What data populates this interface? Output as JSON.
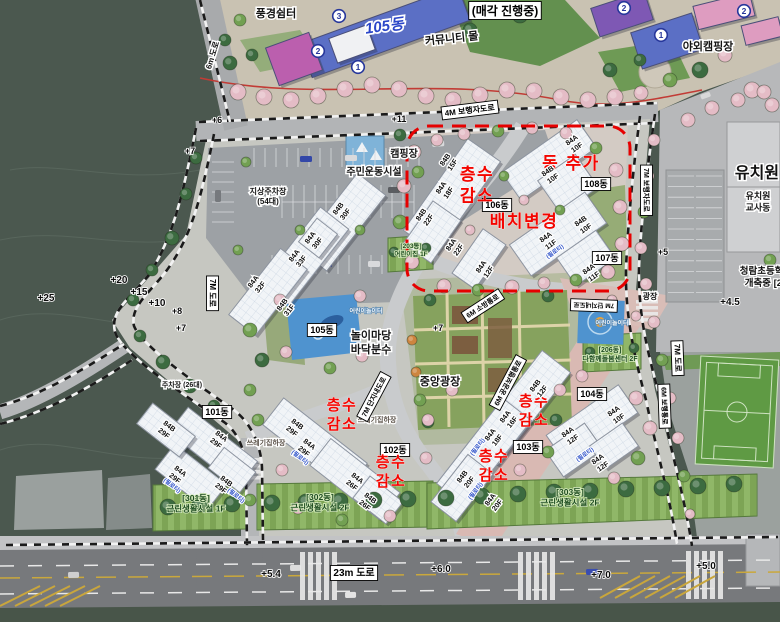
{
  "colors": {
    "annotation_red": "#f30500",
    "change_area_outline": "#e60000",
    "dong_blue": "#2b46c8",
    "building_fill": "#f1f4f7",
    "field_dark": "#4b584f"
  },
  "label_format": [
    "name",
    "text",
    "x",
    "y",
    "rotation",
    "class",
    "font_size"
  ],
  "labels": [
    [
      "bldg-105-main-label",
      "105동",
      385,
      31,
      -8,
      "bluedong",
      15
    ],
    [
      "sale-status-label",
      "(매각 진행중)",
      505,
      15,
      0,
      "box",
      12
    ],
    [
      "punggyeong-shelter-label",
      "풍경쉼터",
      276,
      17,
      0,
      "halo",
      11
    ],
    [
      "community-mall-label",
      "커뮤니티 몰",
      452,
      42,
      -6,
      "halo",
      11
    ],
    [
      "outdoor-camping-label",
      "야외캠핑장",
      708,
      50,
      0,
      "halo",
      11
    ],
    [
      "camping-label",
      "캠핑장",
      404,
      157,
      0,
      "halo",
      10
    ],
    [
      "sports-facility-label",
      "주민운동시설",
      374,
      175,
      0,
      "halo",
      10
    ],
    [
      "ground-parking-label",
      "지상주차장\n(54대)",
      268,
      194,
      0,
      "halo",
      8
    ],
    [
      "parking-26-label",
      "주차장 (26대)",
      182,
      387,
      0,
      "halo",
      7
    ],
    [
      "play-yard-label",
      "놀이마당\n바닥분수",
      371,
      339,
      0,
      "halo",
      11
    ],
    [
      "kids-playground-label-1",
      "어린이놀이터",
      366,
      313,
      0,
      "white",
      6
    ],
    [
      "kids-playground-label-2",
      "어린이놀이터",
      612,
      325,
      0,
      "white",
      6
    ],
    [
      "central-plaza-label",
      "중앙광장",
      440,
      385,
      0,
      "halo",
      11
    ],
    [
      "plaza-label",
      "광장",
      650,
      299,
      0,
      "halo",
      8
    ],
    [
      "waste-station-label-1",
      "쓰레기집하장",
      377,
      422,
      0,
      "halo2",
      7
    ],
    [
      "waste-station-label-2",
      "쓰레기집하장",
      266,
      445,
      0,
      "halo2",
      7
    ],
    [
      "kindergarten-label",
      "유치원",
      757,
      178,
      0,
      "big",
      16
    ],
    [
      "kindergarten-annex-label",
      "유치원\n교사동",
      758,
      199,
      0,
      "halo",
      9
    ],
    [
      "school-label",
      "청람초등학교\n개축중 [25",
      766,
      274,
      0,
      "school",
      9.5
    ],
    [
      "dong-101-label",
      "101동",
      217,
      415,
      0,
      "box",
      9
    ],
    [
      "dong-102-label",
      "102동",
      395,
      453,
      0,
      "box",
      9
    ],
    [
      "dong-103-label",
      "103동",
      528,
      450,
      0,
      "box",
      9
    ],
    [
      "dong-104-label",
      "104동",
      592,
      397,
      0,
      "box",
      9
    ],
    [
      "dong-105-label",
      "105동",
      322,
      333,
      0,
      "box",
      9
    ],
    [
      "dong-106-label",
      "106동",
      497,
      208,
      0,
      "box",
      9
    ],
    [
      "dong-107-label",
      "107동",
      607,
      261,
      0,
      "box",
      9
    ],
    [
      "dong-108-label",
      "108동",
      596,
      187,
      0,
      "box",
      9
    ],
    [
      "road-23m-label",
      "23m 도로",
      354,
      576,
      0,
      "box",
      10
    ],
    [
      "road-4m-ped-label",
      "4M 보행자도로",
      470,
      113,
      -7,
      "box",
      8
    ],
    [
      "road-7m-left-label",
      "7M 도로",
      210,
      293,
      90,
      "box",
      8
    ],
    [
      "road-7m-ped-right-label",
      "7M 보행자도로",
      644,
      190,
      90,
      "box",
      7
    ],
    [
      "road-7m-right-label",
      "7M 도로",
      675,
      358,
      88,
      "box",
      8
    ],
    [
      "road-6m-walk-label",
      "6M 보행통로",
      662,
      406,
      88,
      "box",
      7
    ],
    [
      "road-7m-inner-label",
      "7M 단지내도로",
      376,
      398,
      -62,
      "box",
      7
    ],
    [
      "road-6m-fire-label",
      "6M 소방통로",
      484,
      308,
      -33,
      "box",
      7
    ],
    [
      "road-6m-public-label",
      "6M 공공보행통로",
      510,
      384,
      -62,
      "box",
      7
    ],
    [
      "road-7m-inner-label-2",
      "7M 단지내도로",
      594,
      303,
      182,
      "box",
      6.5
    ],
    [
      "road-6m-topleft-label",
      "6m 도로",
      215,
      56,
      -73,
      "halo",
      8
    ],
    [
      "elev-6",
      "+6",
      217,
      123,
      0,
      "elev",
      9
    ],
    [
      "elev-11",
      "+11",
      399,
      122,
      0,
      "elev",
      9
    ],
    [
      "elev-7a",
      "+7",
      190,
      154,
      0,
      "elev",
      9
    ],
    [
      "elev-25",
      "+25",
      46,
      301,
      0,
      "elev",
      10
    ],
    [
      "elev-20",
      "+20",
      119,
      283,
      0,
      "elev",
      10
    ],
    [
      "elev-15",
      "+15",
      139,
      295,
      0,
      "elev",
      10
    ],
    [
      "elev-10",
      "+10",
      157,
      306,
      0,
      "elev",
      10
    ],
    [
      "elev-8",
      "+8",
      177,
      314,
      0,
      "elev",
      9
    ],
    [
      "elev-7b",
      "+7",
      181,
      331,
      0,
      "elev",
      9
    ],
    [
      "elev-7c",
      "+7",
      438,
      331,
      0,
      "elev",
      9
    ],
    [
      "elev-5",
      "+5",
      663,
      255,
      0,
      "elev",
      9
    ],
    [
      "elev-4p5",
      "+4.5",
      730,
      305,
      0,
      "elev",
      10
    ],
    [
      "elev-5p4",
      "+5.4",
      271,
      577,
      0,
      "elev",
      10
    ],
    [
      "elev-6p0",
      "+6.0",
      441,
      572,
      0,
      "elev",
      10
    ],
    [
      "elev-7p0",
      "+7.0",
      601,
      578,
      0,
      "elev",
      10
    ],
    [
      "elev-5p0",
      "+5.0",
      706,
      569,
      0,
      "elev",
      10
    ],
    [
      "note-floor-decrease-1",
      "층수\n감소",
      477,
      180,
      0,
      "red",
      17
    ],
    [
      "note-building-added",
      "동 추가",
      571,
      169,
      0,
      "red",
      17
    ],
    [
      "note-layout-change",
      "배치변경",
      524,
      227,
      0,
      "red",
      17
    ],
    [
      "note-floor-decrease-2",
      "층수\n감소",
      342,
      410,
      0,
      "red",
      15
    ],
    [
      "note-floor-decrease-3",
      "층수\n감소",
      391,
      467,
      0,
      "red",
      15
    ],
    [
      "note-floor-decrease-4",
      "층수\n감소",
      534,
      406,
      0,
      "red",
      15
    ],
    [
      "note-floor-decrease-5",
      "층수\n감소",
      494,
      461,
      0,
      "red",
      15
    ],
    [
      "facility-301-label",
      "[301동]\n근린생활시설 1F",
      196,
      501,
      0,
      "green",
      8.5
    ],
    [
      "facility-302-label",
      "[302동]\n근린생활시설 2F",
      320,
      500,
      0,
      "green",
      8.5
    ],
    [
      "facility-303-label",
      "[303동]\n근린생활시설 2F",
      570,
      495,
      0,
      "green",
      8.5
    ],
    [
      "facility-206-label",
      "[206동]\n다함께돌봄센터 2F",
      610,
      352,
      0,
      "green",
      7
    ],
    [
      "facility-203-label",
      "[203동]\n어린이집 1F",
      411,
      248,
      0,
      "green",
      6.5
    ],
    [
      "unit-84b30f",
      "84B\n30F",
      340,
      210,
      -52,
      "bldg",
      7.2
    ],
    [
      "unit-84a30f",
      "84A\n30F",
      312,
      239,
      -52,
      "bldg",
      7.2
    ],
    [
      "unit-84a33f",
      "84A\n33F",
      296,
      257,
      -52,
      "bldg",
      7.2
    ],
    [
      "unit-84a32f",
      "84A\n32F",
      255,
      283,
      -52,
      "bldg",
      7.2
    ],
    [
      "unit-84b31f",
      "84B\n31F",
      284,
      306,
      -52,
      "bldg",
      7.2
    ],
    [
      "unit-84b15f",
      "84B\n15F",
      447,
      161,
      -55,
      "bldg",
      7.2
    ],
    [
      "unit-84a18f-1",
      "84A\n18F",
      443,
      189,
      -55,
      "bldg",
      7.2
    ],
    [
      "unit-84b22f",
      "84B\n22F",
      423,
      216,
      -55,
      "bldg",
      7.2
    ],
    [
      "unit-84a22f",
      "84A\n22F",
      453,
      246,
      -55,
      "bldg",
      7.2
    ],
    [
      "unit-84a12f-1",
      "84A\n12F",
      483,
      268,
      -55,
      "bldg",
      7.2
    ],
    [
      "unit-84a10f-1",
      "84A\n10F",
      573,
      142,
      -35,
      "bldg",
      7.2
    ],
    [
      "unit-84b10f-1",
      "84B\n10F",
      549,
      173,
      -35,
      "bldg",
      7.2
    ],
    [
      "unit-84b10f-2",
      "84B\n10F",
      582,
      223,
      -35,
      "bldg",
      7.2
    ],
    [
      "unit-84a11f-1",
      "84A\n11F",
      547,
      239,
      -35,
      "bldg",
      7.2
    ],
    [
      "piloti-1",
      "(필로티)",
      556,
      253,
      -35,
      "piloti",
      5.8
    ],
    [
      "unit-84a11f-2",
      "84A\n11F",
      590,
      271,
      -35,
      "bldg",
      7.2
    ],
    [
      "unit-84b29f-0",
      "84B\n29F",
      168,
      428,
      38,
      "bldg",
      7.2
    ],
    [
      "unit-84a29f-1",
      "84A\n29F",
      220,
      438,
      38,
      "bldg",
      7.2
    ],
    [
      "unit-84a29f-2",
      "84A\n29F",
      179,
      473,
      38,
      "bldg",
      7.2
    ],
    [
      "piloti-2",
      "(필로티)",
      171,
      487,
      38,
      "piloti",
      5.8
    ],
    [
      "unit-84b29f-1",
      "84B\n29F",
      225,
      483,
      38,
      "bldg",
      7.2
    ],
    [
      "piloti-3",
      "(필로티)",
      235,
      497,
      38,
      "piloti",
      5.8
    ],
    [
      "unit-84b29f-2",
      "84B\n29F",
      296,
      426,
      38,
      "bldg",
      7.2
    ],
    [
      "unit-84a29f-3",
      "84A\n29F",
      308,
      446,
      38,
      "bldg",
      7.2
    ],
    [
      "piloti-4",
      "(필로티)",
      299,
      459,
      38,
      "piloti",
      5.8
    ],
    [
      "unit-84a26f",
      "84A\n26F",
      356,
      480,
      38,
      "bldg",
      7.2
    ],
    [
      "unit-84b26f",
      "84B\n26F",
      369,
      500,
      38,
      "bldg",
      7.2
    ],
    [
      "unit-84b12f",
      "84B\n12F",
      537,
      387,
      -52,
      "bldg",
      7.2
    ],
    [
      "unit-84a16f",
      "84A\n16F",
      507,
      418,
      -52,
      "bldg",
      7.2
    ],
    [
      "unit-84a18f-2",
      "84A\n18F",
      492,
      436,
      -52,
      "bldg",
      7.2
    ],
    [
      "piloti-5",
      "(필로티)",
      479,
      448,
      -52,
      "piloti",
      5.8
    ],
    [
      "unit-84b20f",
      "84B\n20F",
      464,
      478,
      -52,
      "bldg",
      7.2
    ],
    [
      "piloti-6",
      "(필로티)",
      477,
      492,
      -52,
      "piloti",
      5.8
    ],
    [
      "unit-84a20f",
      "84A\n20F",
      492,
      501,
      -52,
      "bldg",
      7.2
    ],
    [
      "unit-84a10f-2",
      "84A\n10F",
      615,
      413,
      -35,
      "bldg",
      7.2
    ],
    [
      "unit-84a12f-2",
      "84A\n12F",
      569,
      434,
      -35,
      "bldg",
      7.2
    ],
    [
      "piloti-7",
      "(필로티)",
      586,
      456,
      -35,
      "piloti",
      5.8
    ],
    [
      "unit-84a12f-3",
      "84A\n12F",
      599,
      461,
      -35,
      "bldg",
      7.2
    ]
  ],
  "circled_numbers": [
    [
      "circled-3",
      "3",
      339,
      16
    ],
    [
      "circled-2a",
      "2",
      318,
      51
    ],
    [
      "circled-1a",
      "1",
      358,
      67
    ],
    [
      "circled-2b",
      "2",
      624,
      8
    ],
    [
      "circled-1b",
      "1",
      661,
      35
    ],
    [
      "circled-2c",
      "2",
      744,
      11
    ]
  ]
}
